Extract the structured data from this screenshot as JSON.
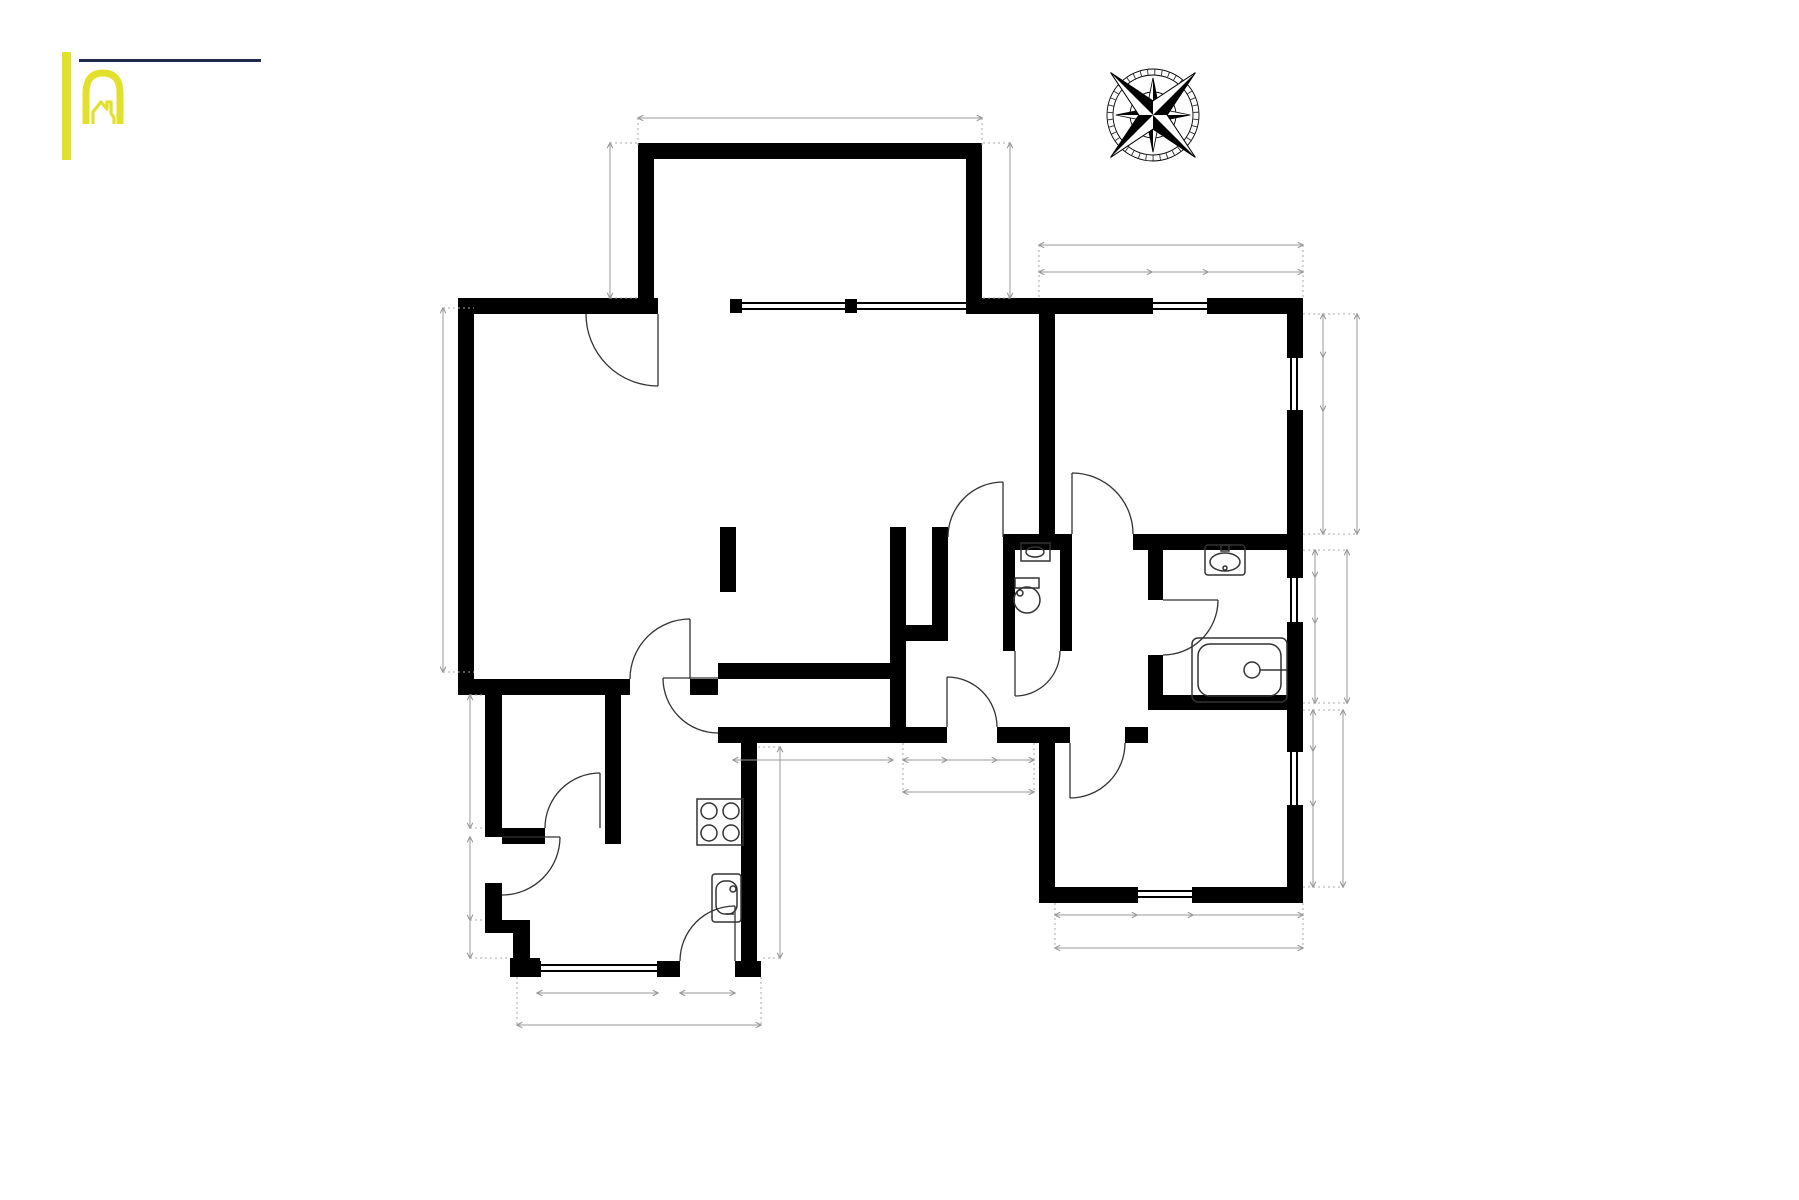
{
  "logo": {
    "line1": "Immobilière",
    "wordmark": "HACK",
    "wordmark_left": "H",
    "wordmark_right": "CK"
  },
  "colors": {
    "brand_navy": "#1f2a4e",
    "brand_yellow": "#e3e02c",
    "wall_black": "#000000",
    "dimension_gray": "#999999"
  },
  "compass": {
    "n": "N",
    "e": "E",
    "s": "S",
    "w": "W",
    "minor": [
      "ne",
      "se",
      "sw",
      "nw"
    ]
  },
  "footer": {
    "title": "Rez-de-chaussée",
    "subtitle": "Les plans sont soumis à titre informatif et non contractuels."
  },
  "rooms": [
    {
      "id": "terrasse",
      "name": "Terrasse",
      "area": "12.56 m² (5.34 × 2.35)",
      "area2": "",
      "x": 810,
      "y": 187
    },
    {
      "id": "salon",
      "name": "Salon",
      "area": "46.01 m² (8.81 × 6.06)",
      "area2": "",
      "x": 723,
      "y": 488
    },
    {
      "id": "chambre-1",
      "name": "Chambre à coucher",
      "area": "14.08 m² (3.89 × 3.69)",
      "area2": "",
      "x": 1171,
      "y": 406
    },
    {
      "id": "placard",
      "name": "Placard",
      "area": "",
      "area2": "",
      "x": 919,
      "y": 582
    },
    {
      "id": "toilettes",
      "name": "Toilettes",
      "area": "1.12 m²",
      "area2": "0.90 × 1.24",
      "x": 1040,
      "y": 578
    },
    {
      "id": "salle-de-bains",
      "name": "Salle de bains",
      "area": "5.16 m² (2.08 × 2.48)",
      "area2": "",
      "x": 1215,
      "y": 604
    },
    {
      "id": "hall",
      "name": "Hall",
      "area": "8.07 m² (3.78 × 3.02)",
      "area2": "",
      "x": 960,
      "y": 656
    },
    {
      "id": "rangement",
      "name": "Rangement",
      "area": "2.69 m² (2.68 × 1.01)",
      "area2": "",
      "x": 806,
      "y": 700
    },
    {
      "id": "buanderie",
      "name": "Buanderie",
      "area": "3.08 m² (1.64 × 1.99)",
      "area2": "",
      "x": 553,
      "y": 770
    },
    {
      "id": "cuisine",
      "name": "Cuisine",
      "area": "11.19 m² (3.84 × 4.08)",
      "area2": "",
      "x": 625,
      "y": 900
    },
    {
      "id": "chambre-2",
      "name": "Chambre à coucher",
      "area": "9.67 m² (3.54 × 2.73)",
      "area2": "",
      "x": 1172,
      "y": 802
    }
  ],
  "dimensions": [
    {
      "v": "5.34",
      "x": 810,
      "y": 118,
      "rot": 0
    },
    {
      "v": "2.35",
      "x": 610,
      "y": 220,
      "rot": 1
    },
    {
      "v": "2.35",
      "x": 1010,
      "y": 220,
      "rot": 1
    },
    {
      "v": "3.89",
      "x": 1171,
      "y": 245,
      "rot": 0
    },
    {
      "v": "1.80",
      "x": 1096,
      "y": 272,
      "rot": 0
    },
    {
      "v": "0.86",
      "x": 1180,
      "y": 272,
      "rot": 0
    },
    {
      "v": "1.23",
      "x": 1256,
      "y": 272,
      "rot": 0
    },
    {
      "v": "0.93",
      "x": 1323,
      "y": 336,
      "rot": 1
    },
    {
      "v": "0.86",
      "x": 1323,
      "y": 384,
      "rot": 1
    },
    {
      "v": "1.90",
      "x": 1323,
      "y": 473,
      "rot": 1
    },
    {
      "v": "3.69",
      "x": 1357,
      "y": 424,
      "rot": 1
    },
    {
      "v": "0.44",
      "x": 1315,
      "y": 564,
      "rot": 1
    },
    {
      "v": "0.80",
      "x": 1315,
      "y": 600,
      "rot": 1
    },
    {
      "v": "1.24",
      "x": 1315,
      "y": 663,
      "rot": 1
    },
    {
      "v": "2.48",
      "x": 1347,
      "y": 627,
      "rot": 1
    },
    {
      "v": "0.76",
      "x": 1313,
      "y": 730,
      "rot": 1
    },
    {
      "v": "0.88",
      "x": 1313,
      "y": 779,
      "rot": 1
    },
    {
      "v": "1.09",
      "x": 1313,
      "y": 847,
      "rot": 1
    },
    {
      "v": "2.73",
      "x": 1343,
      "y": 798,
      "rot": 1
    },
    {
      "v": "1.26",
      "x": 1096,
      "y": 915,
      "rot": 0
    },
    {
      "v": "0.88",
      "x": 1165,
      "y": 915,
      "rot": 0
    },
    {
      "v": "1.40",
      "x": 1248,
      "y": 915,
      "rot": 0
    },
    {
      "v": "3.54",
      "x": 1179,
      "y": 948,
      "rot": 0
    },
    {
      "v": "6.05",
      "x": 443,
      "y": 490,
      "rot": 1
    },
    {
      "v": "1.99",
      "x": 470,
      "y": 765,
      "rot": 1
    },
    {
      "v": "1.36",
      "x": 470,
      "y": 878,
      "rot": 1
    },
    {
      "v": "0.60",
      "x": 470,
      "y": 940,
      "rot": 1
    },
    {
      "v": "2.94",
      "x": 780,
      "y": 852,
      "rot": 1
    },
    {
      "v": "1.95",
      "x": 598,
      "y": 993,
      "rot": 0
    },
    {
      "v": "0.88",
      "x": 708,
      "y": 993,
      "rot": 0
    },
    {
      "v": "3.44",
      "x": 639,
      "y": 1025,
      "rot": 0
    },
    {
      "v": "2.68",
      "x": 813,
      "y": 760,
      "rot": 0
    },
    {
      "v": "0.70",
      "x": 925,
      "y": 760,
      "rot": 0
    },
    {
      "v": "0.80",
      "x": 972,
      "y": 760,
      "rot": 0
    },
    {
      "v": "0.58",
      "x": 1015,
      "y": 760,
      "rot": 0
    },
    {
      "v": "2.08",
      "x": 968,
      "y": 792,
      "rot": 0
    }
  ]
}
